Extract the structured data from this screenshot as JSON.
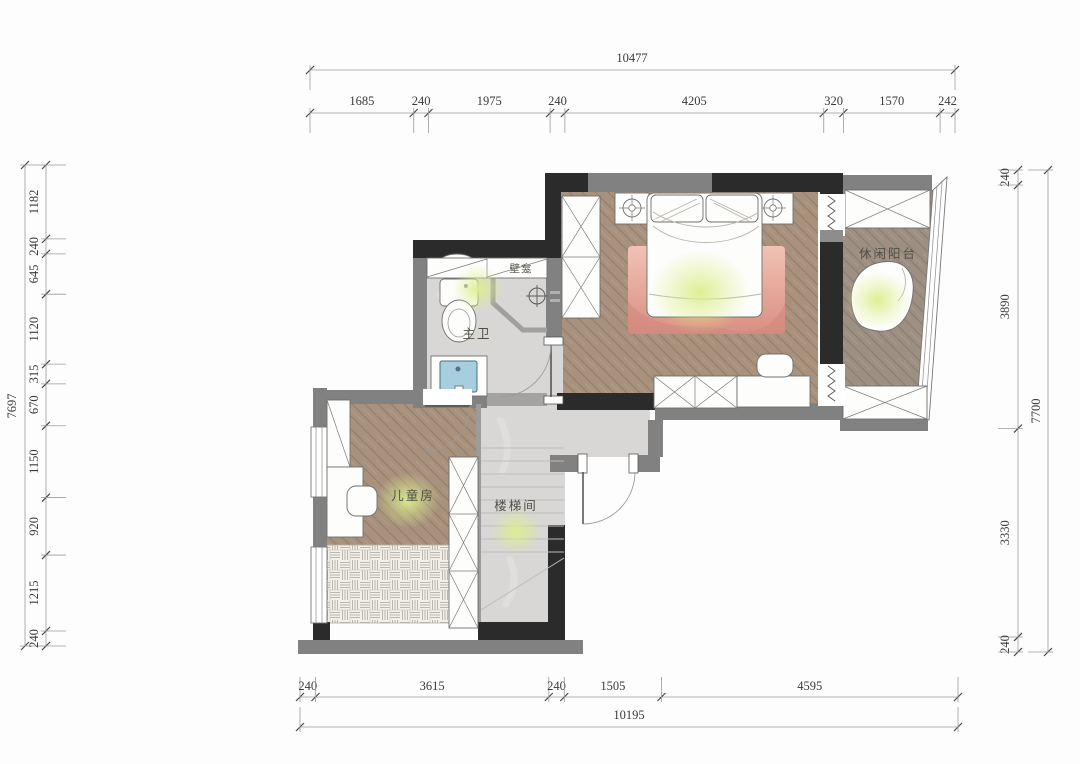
{
  "rooms": {
    "master_bath": "主卫",
    "niche": "壁龛",
    "leisure_balcony": "休闲阳台",
    "kids_room": "儿童房",
    "stairwell": "楼梯间"
  },
  "dimensions": {
    "top": {
      "total": 10477,
      "segments": [
        1685,
        240,
        1975,
        240,
        4205,
        320,
        1570,
        242
      ]
    },
    "bottom": {
      "total": 10195,
      "segments": [
        240,
        3615,
        240,
        1505,
        4595
      ]
    },
    "left": {
      "total": 7697,
      "segments": [
        1182,
        240,
        645,
        1120,
        315,
        670,
        1150,
        920,
        1215,
        240
      ]
    },
    "right": {
      "total": 7700,
      "segments": [
        240,
        3890,
        3330,
        240
      ]
    }
  },
  "colors": {
    "wall_dark": "#2b2b2b",
    "wall_gray": "#818181",
    "wood": "#a8917d",
    "balcony_wood": "#9d9083",
    "marble": "#d8d7d5",
    "rug_pink": "#e2a396",
    "glow": "#dcee8e",
    "sink_blue": "#a6cede"
  }
}
